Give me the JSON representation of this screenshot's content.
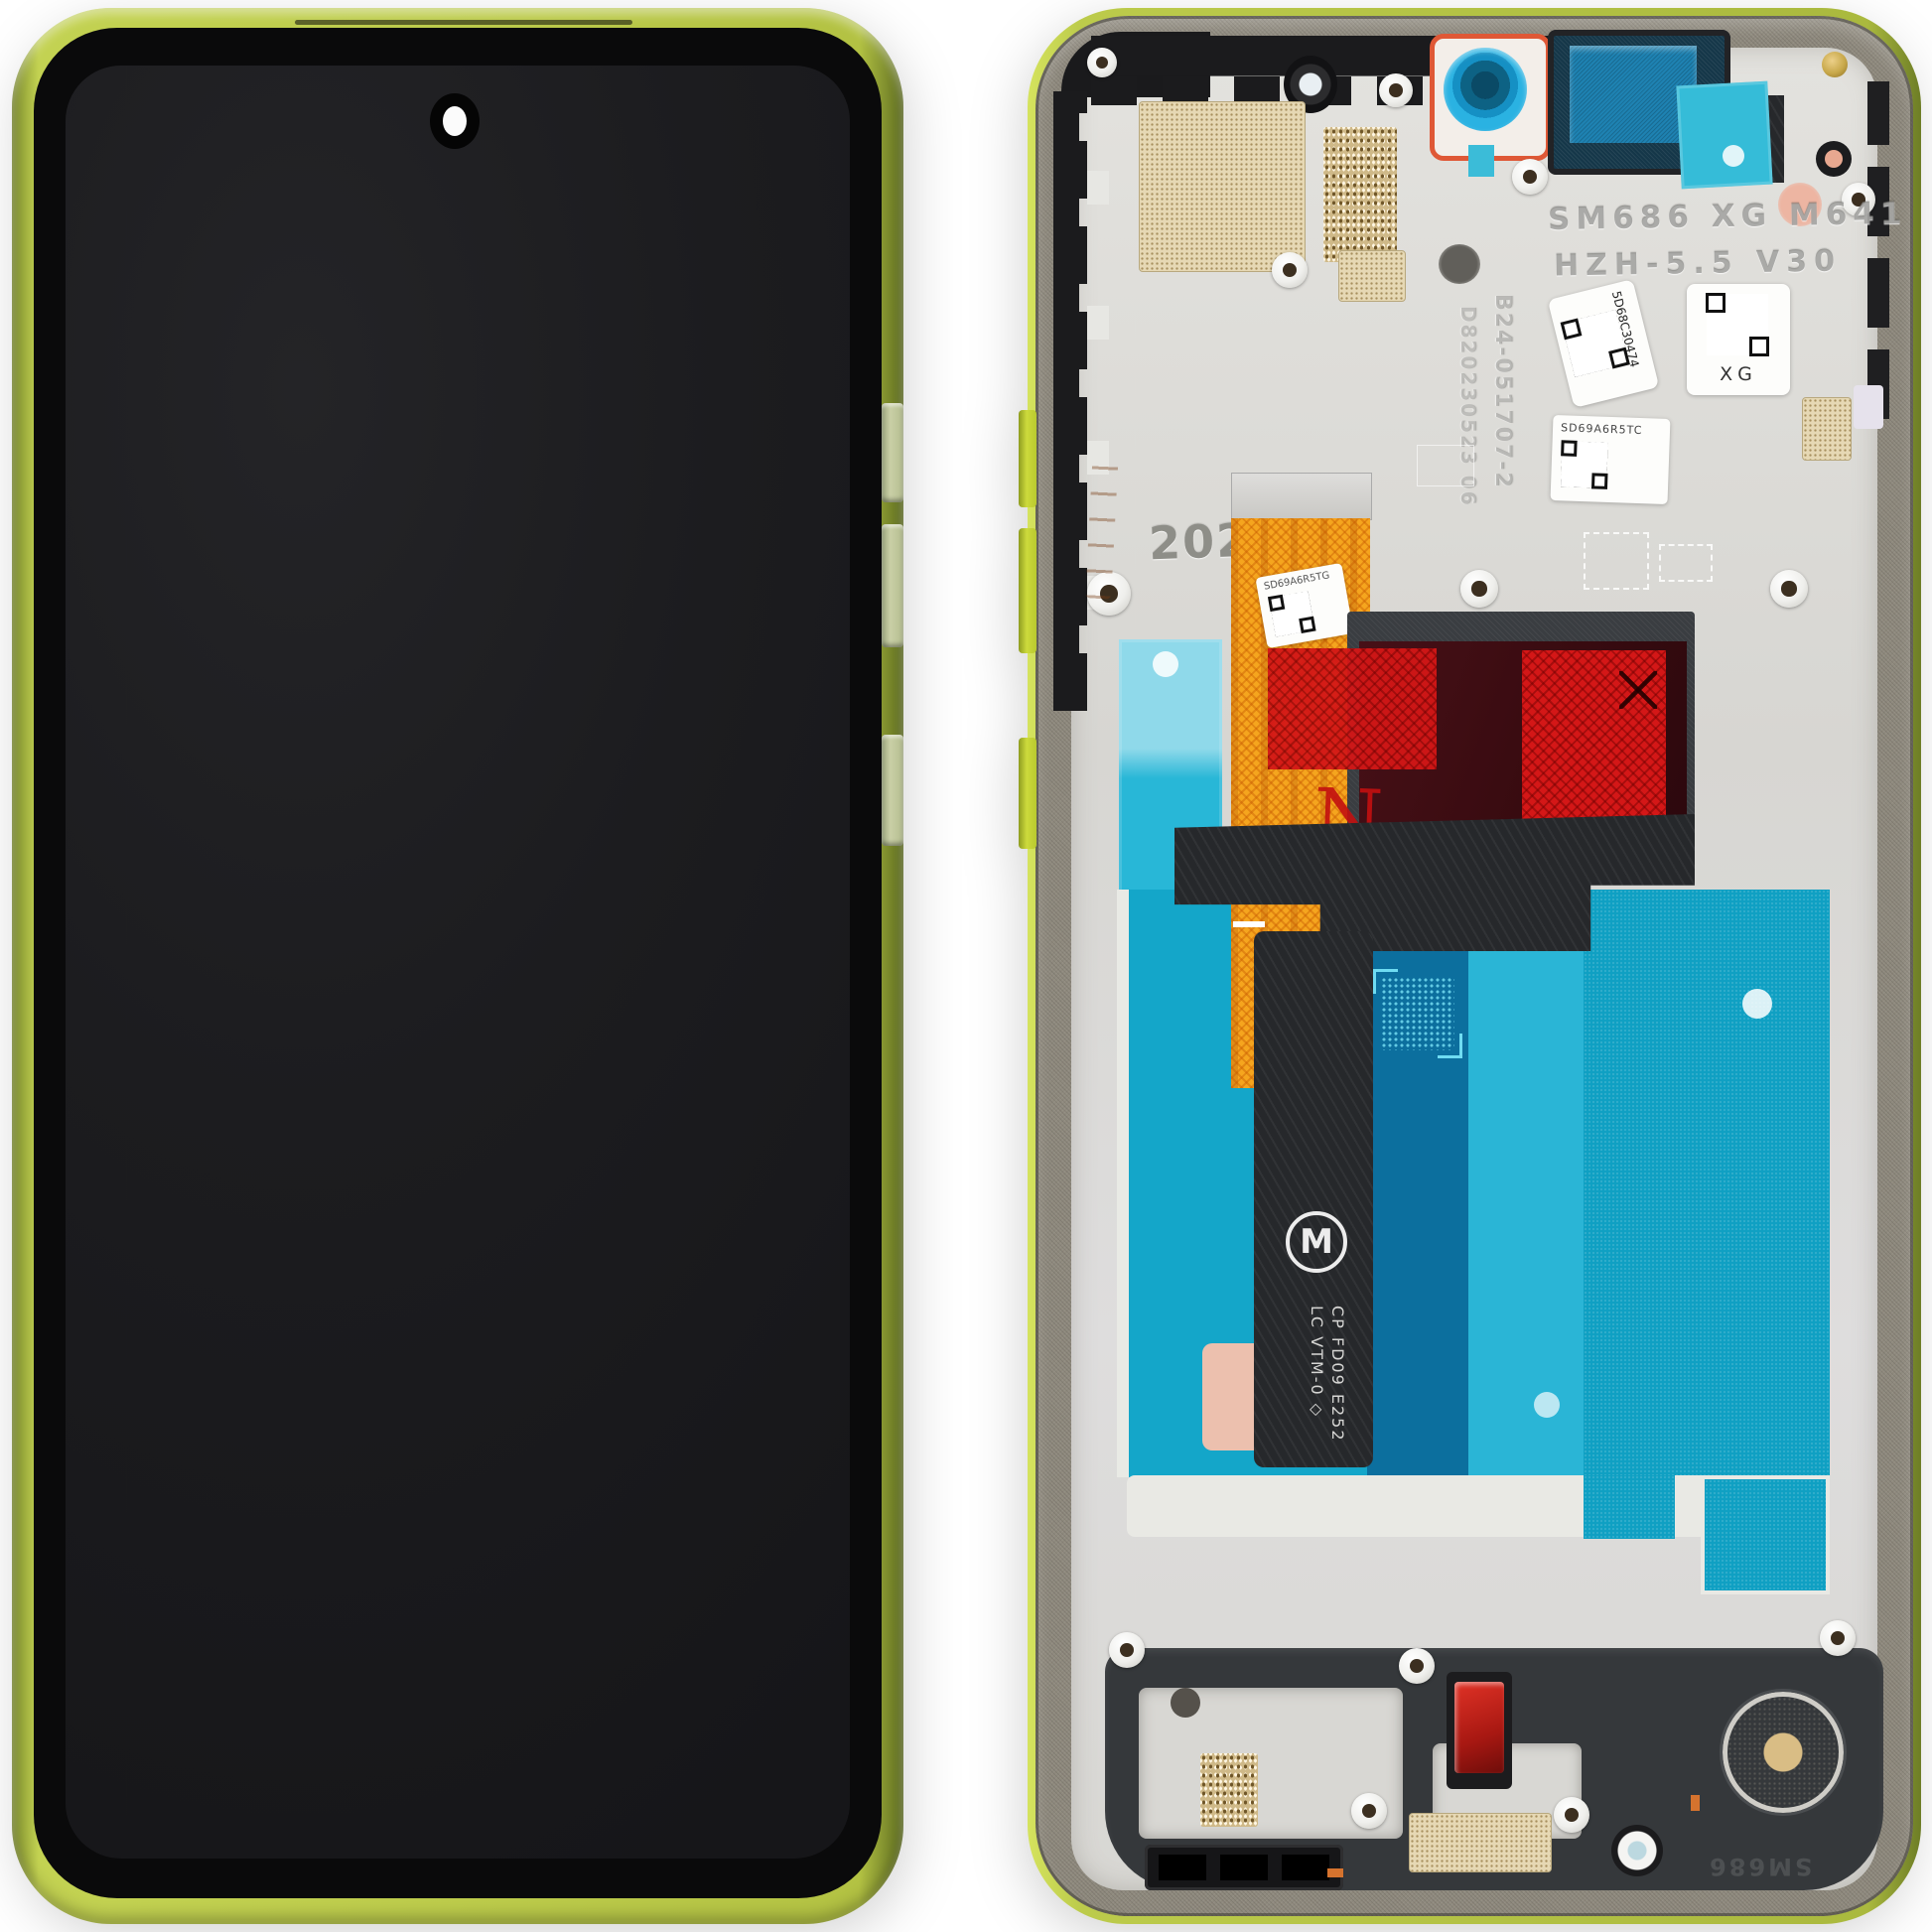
{
  "product": {
    "description": "Smartphone LCD display assembly with lime green frame, front and back views"
  },
  "back": {
    "emboss_line1": "SM686 XG M641",
    "emboss_line2": "HZH-5.5 V30",
    "emboss_year": "2025",
    "emboss_serial_a": "D820230523 06",
    "emboss_serial_b": "B24-051707-2",
    "emboss_bottom": "SM686",
    "sticker1": "5D68C30474",
    "sticker2": "XG",
    "sticker3": "SD69A6R5TC",
    "sticker4": "SD69A6R5TG",
    "flex_line1": "CP FD09 E252",
    "flex_line2": "LC VTM-0 ◇",
    "stamp_n": "N",
    "logo": "M"
  },
  "colors": {
    "frame_lime": "#bccb4b",
    "metal_frame": "#8e897d",
    "plate_silver": "#dcdbd7",
    "adhesive_cyan": "#14a6c9",
    "flex_orange": "#f5a51e",
    "tape_red": "#d41717",
    "camera_blue": "#2ab2e2",
    "pad_pink": "#ecc0ae"
  }
}
